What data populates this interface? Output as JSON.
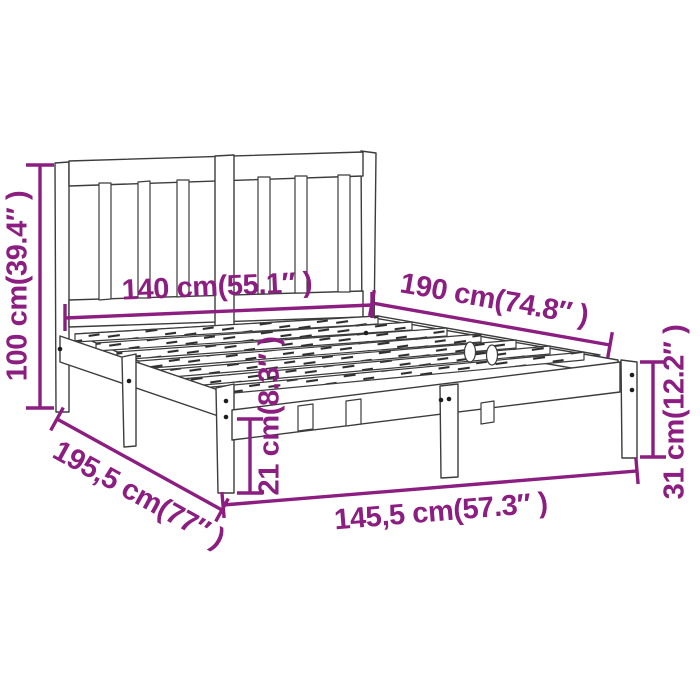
{
  "page": {
    "background": "#ffffff",
    "title": "Bed frame dimensions diagram"
  },
  "diagram": {
    "subject": "wooden-bed-frame-with-headboard",
    "accent_color": "#8B1E80",
    "outline_color": "#3C3C3C",
    "dimensions": [
      {
        "id": "headboard-height",
        "label": "100 cm(39.4″ )"
      },
      {
        "id": "headboard-width",
        "label": "140 cm(55.1″ )"
      },
      {
        "id": "mattress-length",
        "label": "190 cm(74.8″ )"
      },
      {
        "id": "total-length",
        "label": "195,5 cm(77″ )"
      },
      {
        "id": "total-width",
        "label": "145,5 cm(57.3″ )"
      },
      {
        "id": "under-bed-clearance",
        "label": "21 cm(8.3″ )"
      },
      {
        "id": "foot-end-height",
        "label": "31 cm(12.2″ )"
      }
    ]
  }
}
